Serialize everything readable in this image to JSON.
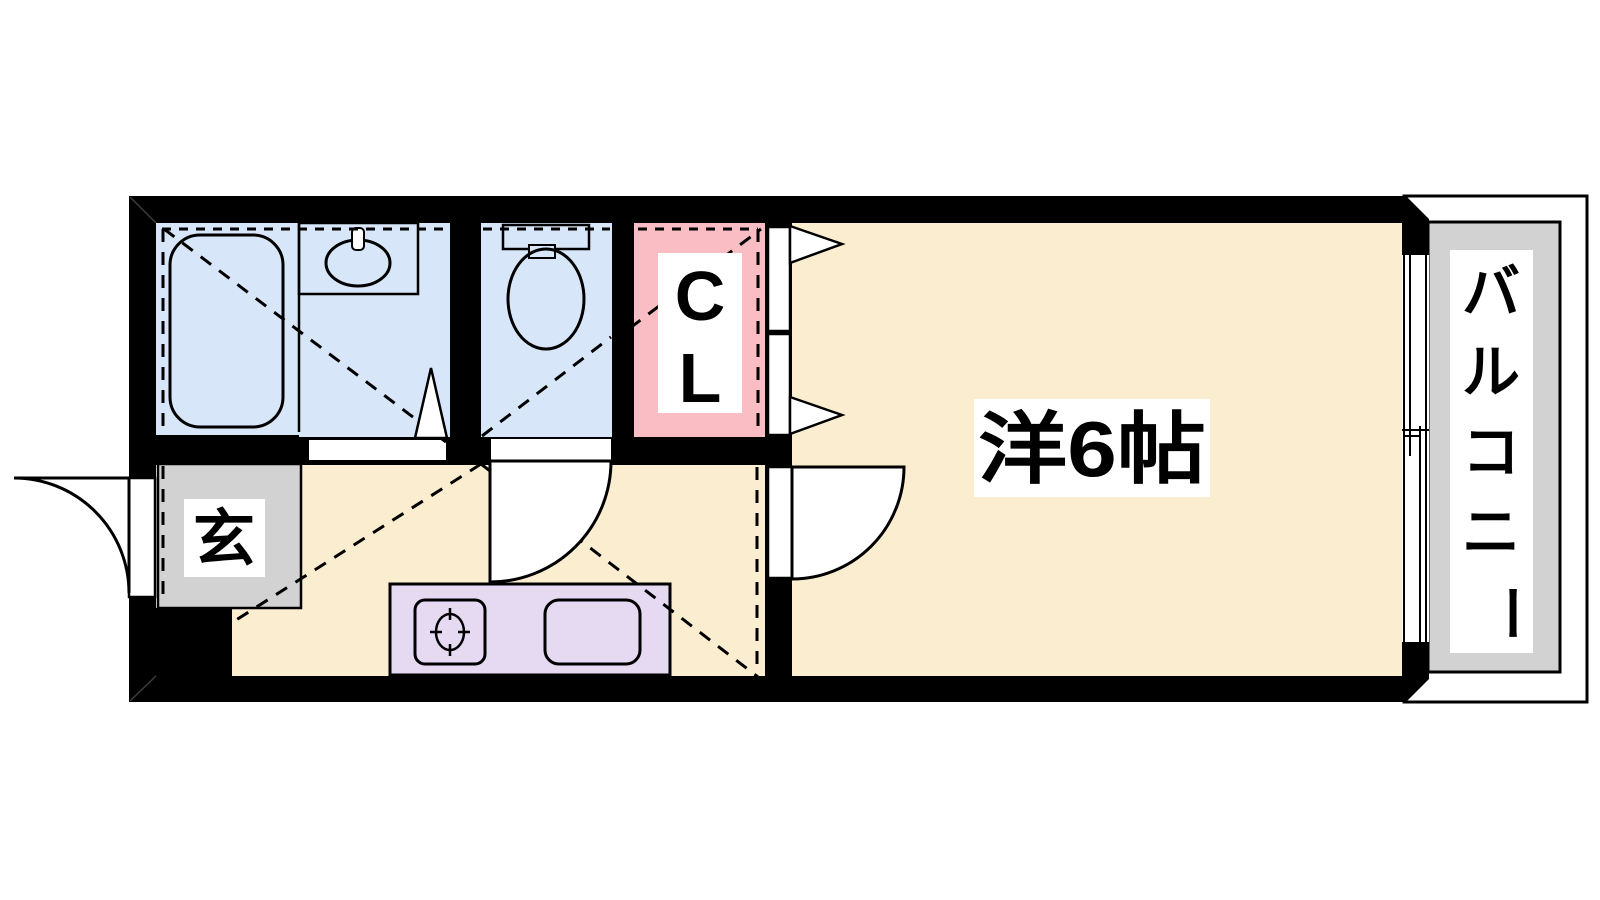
{
  "page": {
    "type": "apartment-floor-plan",
    "background": "#ffffff"
  },
  "colors": {
    "wall": "#000000",
    "line": "#000000",
    "wet_blue": "#d7e6f8",
    "room_cream": "#fbeed0",
    "closet_pink": "#f9bdc3",
    "counter_lavender": "#e6d9f2",
    "entry_gray": "#d2d2d2",
    "balcony_gray": "#d2d2d2",
    "paper_white": "#ffffff"
  },
  "rooms": {
    "main_room": {
      "label": "洋6帖"
    },
    "closet": {
      "label": "CL",
      "chars": [
        "C",
        "L"
      ]
    },
    "entrance": {
      "label": "玄"
    },
    "balcony": {
      "label": "バルコニー",
      "chars": [
        "バ",
        "ル",
        "コ",
        "ニ",
        "ー"
      ]
    }
  },
  "fixtures": [
    "bathtub",
    "washbasin",
    "toilet",
    "gas-stove",
    "kitchen-sink",
    "sliding-window",
    "entrance-door",
    "room-door",
    "washroom-door",
    "closet-doors"
  ]
}
